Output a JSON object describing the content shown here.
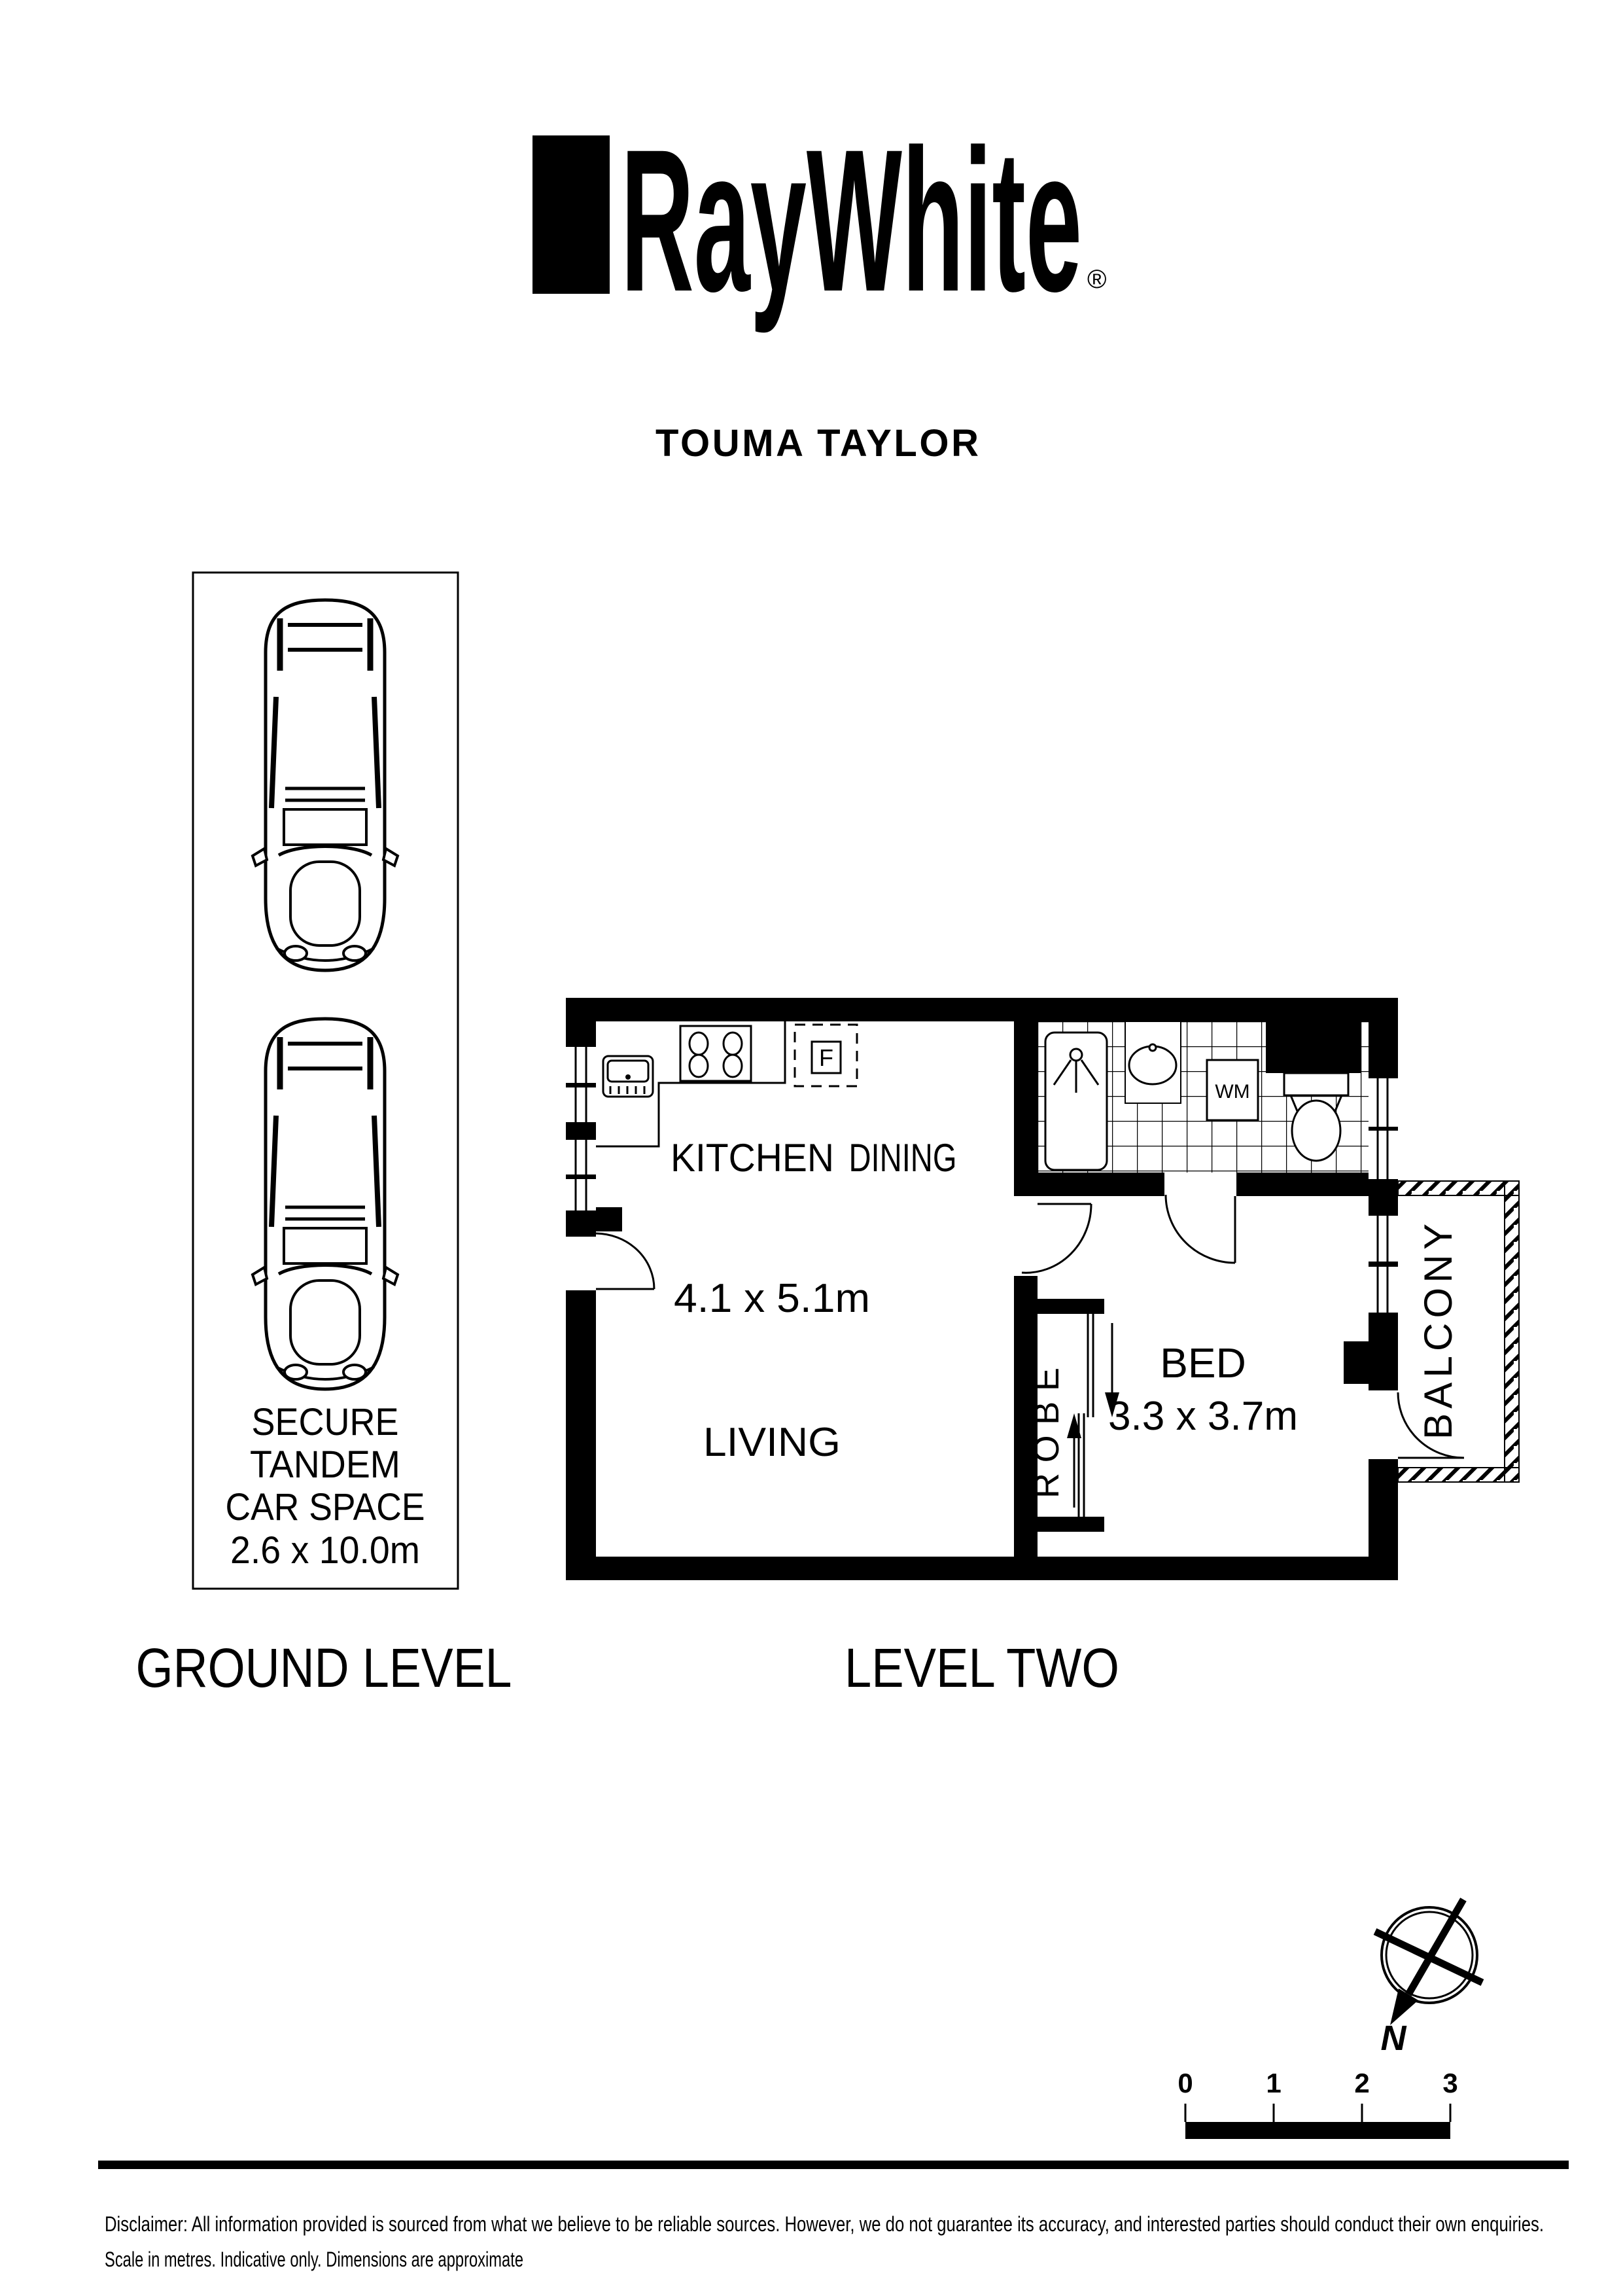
{
  "brand": {
    "logo_text": "RayWhite",
    "registered_mark": "®",
    "office_name": "TOUMA TAYLOR"
  },
  "ground_level": {
    "label": "GROUND LEVEL",
    "car_space": {
      "line1": "SECURE",
      "line2": "TANDEM",
      "line3": "CAR SPACE",
      "line4": "2.6 x 10.0m"
    }
  },
  "level_two": {
    "label": "LEVEL TWO",
    "kitchen_label": "KITCHEN",
    "dining_label": "DINING",
    "kitchen_dining_dimensions": "4.1 x 5.1m",
    "living_label": "LIVING",
    "bed_label": "BED",
    "bed_dimensions": "3.3 x 3.7m",
    "robe_label": "ROBE",
    "balcony_label": "BALCONY",
    "washing_machine_label": "WM",
    "fridge_label": "F"
  },
  "compass": {
    "north_label": "N"
  },
  "scale_bar": {
    "tick_0": "0",
    "tick_1": "1",
    "tick_2": "2",
    "tick_3": "3"
  },
  "disclaimer": {
    "line1": "Disclaimer: All information provided is sourced from what we believe to be reliable sources. However, we do not guarantee  its accuracy, and interested parties should conduct their own enquiries.",
    "line2": "Scale in metres. Indicative only. Dimensions are approximate"
  }
}
